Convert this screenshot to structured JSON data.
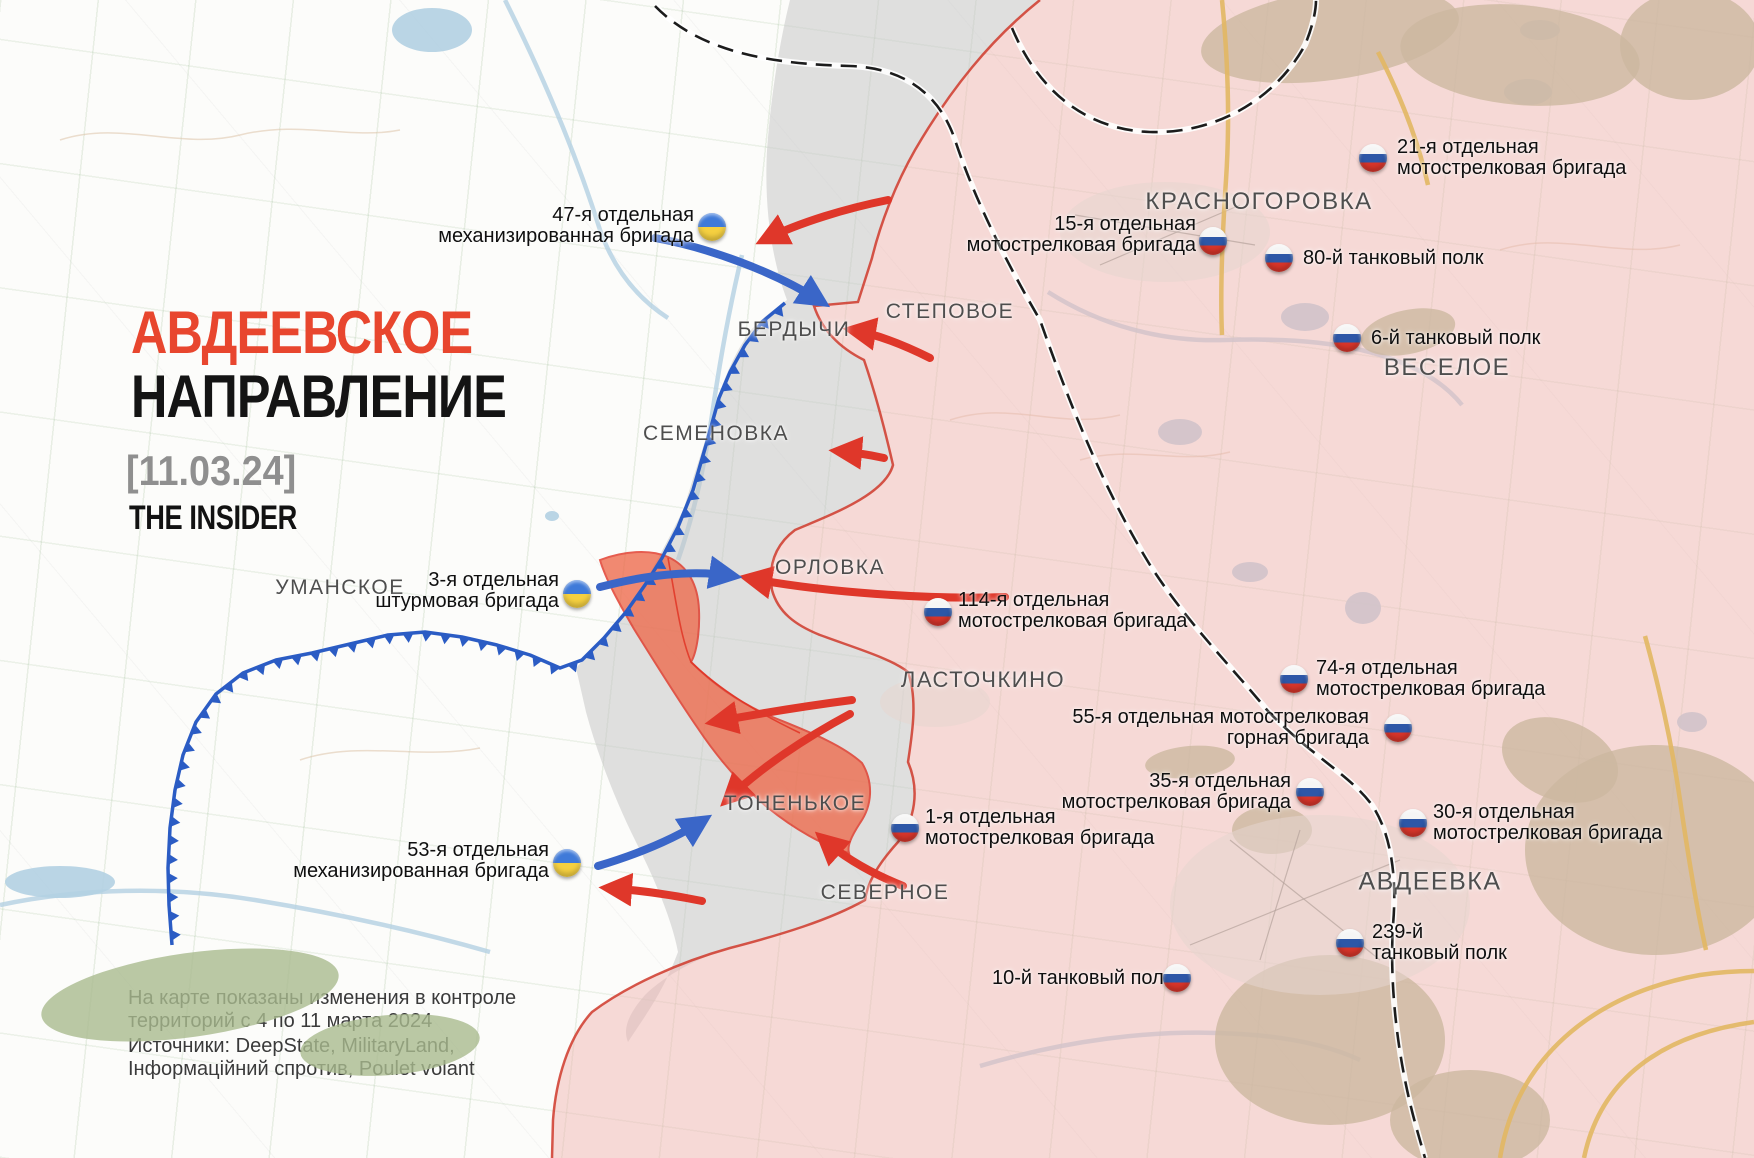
{
  "title": {
    "line1": "АВДЕЕВСКОЕ",
    "line2": "НАПРАВЛЕНИЕ",
    "date": "[11.03.24]",
    "brand": "THE INSIDER",
    "line1_color": "#e8462e",
    "line2_color": "#141414"
  },
  "footer": {
    "note_line1": "На карте показаны изменения в контроле",
    "note_line2": "территорий с 4 по 11 марта 2024",
    "sources_line1": "Источники: DeepState, MilitaryLand,",
    "sources_line2": "Інформаційний спротив, Poulet volant"
  },
  "places": [
    {
      "name": "БЕРДЫЧИ",
      "x": 794,
      "y": 330,
      "size": 21
    },
    {
      "name": "СТЕПОВОЕ",
      "x": 950,
      "y": 312,
      "size": 21
    },
    {
      "name": "СЕМЕНОВКА",
      "x": 716,
      "y": 434,
      "size": 21
    },
    {
      "name": "ОРЛОВКА",
      "x": 830,
      "y": 568,
      "size": 21
    },
    {
      "name": "УМАНСКОЕ",
      "x": 340,
      "y": 588,
      "size": 21
    },
    {
      "name": "ЛАСТОЧКИНО",
      "x": 983,
      "y": 680,
      "size": 22
    },
    {
      "name": "ТОНЕНЬКОЕ",
      "x": 795,
      "y": 804,
      "size": 21
    },
    {
      "name": "СЕВЕРНОЕ",
      "x": 885,
      "y": 893,
      "size": 21
    },
    {
      "name": "КРАСНОГОРОВКА",
      "x": 1259,
      "y": 202,
      "size": 24
    },
    {
      "name": "ВЕСЕЛОЕ",
      "x": 1447,
      "y": 368,
      "size": 24
    },
    {
      "name": "АВДЕЕВКА",
      "x": 1430,
      "y": 882,
      "size": 25
    }
  ],
  "units": [
    {
      "country": "ua",
      "lines": [
        "47-я отдельная",
        "механизированная бригада"
      ]
    },
    {
      "country": "ua",
      "lines": [
        "3-я отдельная",
        "штурмовая бригада"
      ]
    },
    {
      "country": "ua",
      "lines": [
        "53-я отдельная",
        "механизированная бригада"
      ]
    },
    {
      "country": "ru",
      "lines": [
        "21-я отдельная",
        "мотострелковая бригада"
      ]
    },
    {
      "country": "ru",
      "lines": [
        "15-я отдельная",
        "мотострелковая бригада"
      ]
    },
    {
      "country": "ru",
      "lines": [
        "80-й танковый полк"
      ]
    },
    {
      "country": "ru",
      "lines": [
        "6-й танковый полк"
      ]
    },
    {
      "country": "ru",
      "lines": [
        "114-я отдельная",
        "мотострелковая бригада"
      ]
    },
    {
      "country": "ru",
      "lines": [
        "74-я отдельная",
        "мотострелковая бригада"
      ]
    },
    {
      "country": "ru",
      "lines": [
        "55-я отдельная мотострелковая",
        "горная бригада"
      ]
    },
    {
      "country": "ru",
      "lines": [
        "35-я отдельная",
        "мотострелковая бригада"
      ]
    },
    {
      "country": "ru",
      "lines": [
        "30-я отдельная",
        "мотострелковая бригада"
      ]
    },
    {
      "country": "ru",
      "lines": [
        "1-я отдельная",
        "мотострелковая бригада"
      ]
    },
    {
      "country": "ru",
      "lines": [
        "239-й",
        "танковый полк"
      ]
    },
    {
      "country": "ru",
      "lines": [
        "10-й танковый полк"
      ]
    }
  ],
  "colors": {
    "pink_zone": "#efb6b1",
    "pink_edge": "#cf3a2c",
    "gray_zone": "#c7c7c7",
    "orange_zone": "#ee6a4b",
    "orange_edge": "#e03020",
    "frontline": "#2b5cc4",
    "blue_arrow": "#3a66c8",
    "red_arrow": "#df372a",
    "rail": "#1c1c1c",
    "road": "#e2b763",
    "forest": "#a9ba8e",
    "water": "#b3d0e2",
    "contour": "#d9bd9f",
    "urban": "#e6d6d0",
    "urban_street": "#b5a29b"
  },
  "map": {
    "frontline": [
      [
        785,
        303
      ],
      [
        762,
        322
      ],
      [
        745,
        345
      ],
      [
        730,
        372
      ],
      [
        719,
        398
      ],
      [
        706,
        445
      ],
      [
        693,
        490
      ],
      [
        678,
        527
      ],
      [
        662,
        558
      ],
      [
        645,
        585
      ],
      [
        626,
        612
      ],
      [
        604,
        638
      ],
      [
        582,
        660
      ],
      [
        560,
        668
      ],
      [
        530,
        655
      ],
      [
        497,
        645
      ],
      [
        462,
        637
      ],
      [
        425,
        632
      ],
      [
        388,
        635
      ],
      [
        350,
        644
      ],
      [
        312,
        653
      ],
      [
        276,
        660
      ],
      [
        243,
        673
      ],
      [
        216,
        694
      ],
      [
        196,
        722
      ],
      [
        183,
        755
      ],
      [
        175,
        790
      ],
      [
        170,
        828
      ],
      [
        168,
        868
      ],
      [
        169,
        905
      ],
      [
        172,
        945
      ]
    ],
    "zones": {
      "gray": "M 790,0 L 1040,0 C 990,40 950,90 915,150 C 895,185 880,225 872,258 L 858,302 L 814,306 C 822,330 840,348 864,360 C 876,395 885,430 893,465 C 885,495 830,515 795,530 C 775,545 768,565 772,590 C 778,612 795,625 820,635 C 855,648 890,658 908,672 C 918,700 912,735 908,762 C 920,790 915,820 898,842 C 880,862 868,880 865,900 C 830,920 780,935 730,948 C 700,957 665,975 645,995 C 630,1012 622,1028 628,1042 C 642,1020 662,995 678,952 C 672,920 655,880 636,842 C 616,802 598,756 586,712 L 576,668 C 592,650 610,630 627,610 C 647,580 666,545 684,508 C 698,462 709,430 716,405 C 723,380 735,352 751,330 C 765,315 777,308 787,300 C 772,260 764,210 767,150 C 771,95 780,40 790,0 Z",
      "pink": "M 1040,0 C 990,40 950,90 915,150 C 895,185 880,225 872,258 L 858,302 L 814,306 C 822,330 840,348 864,360 C 876,395 885,430 893,465 C 885,495 830,515 795,530 C 775,545 768,565 772,590 C 778,612 795,625 820,635 C 855,648 890,658 908,672 C 918,700 912,735 908,762 C 920,790 915,820 898,842 C 880,862 868,880 865,900 C 830,920 780,935 730,948 C 680,962 628,985 592,1012 C 568,1038 556,1080 553,1120 L 552,1158 L 1754,1158 L 1754,0 Z",
      "pink_edge": "M 1040,0 C 990,40 950,90 915,150 C 895,185 880,225 872,258 L 858,302 L 814,306 C 822,330 840,348 864,360 C 876,395 885,430 893,465 C 885,495 830,515 795,530 C 775,545 768,565 772,590 C 778,612 795,625 820,635 C 855,648 890,658 908,672 C 918,700 912,735 908,762 C 920,790 915,820 898,842 C 880,862 868,880 865,900 C 830,920 780,935 730,948 C 680,962 628,985 592,1012 C 568,1038 556,1080 553,1120 L 552,1158",
      "orange": "M 600,560 C 624,551 650,549 668,557 C 688,566 698,585 699,610 C 700,634 696,654 691,662 C 714,685 740,703 770,716 C 804,730 840,743 862,763 C 874,783 872,806 860,823 C 851,837 847,846 849,853 C 824,846 794,829 767,807 C 741,785 717,757 697,727 C 675,695 654,661 634,629 C 619,603 606,580 600,560 Z",
      "orange_inner": [
        "M 668,558 C 676,600 680,635 691,662",
        "M 691,662 C 720,690 756,712 800,733"
      ]
    },
    "red_arrows": [
      "M 888,200 C 848,208 800,222 764,240",
      "M 930,358 C 902,344 876,334 852,330",
      "M 884,458 C 866,454 850,452 838,451",
      "M 1005,597 C 930,600 820,592 748,578",
      "M 852,700 C 806,706 762,713 714,722",
      "M 850,714 C 805,738 760,768 727,800",
      "M 903,886 C 868,872 842,856 822,838",
      "M 702,901 C 668,894 636,890 608,888"
    ],
    "blue_arrows": [
      "M 655,238 C 710,248 775,272 822,302",
      "M 600,587 C 650,574 695,570 733,576",
      "M 598,866 C 638,854 676,838 704,820"
    ],
    "railways": [
      "M 655,6 C 700,52 770,64 850,66 C 905,68 940,95 955,140 C 975,200 1005,260 1040,320 C 1075,420 1110,500 1150,565 C 1185,620 1230,665 1267,710 C 1310,755 1350,775 1372,805 C 1392,835 1397,880 1393,925 C 1390,975 1395,1030 1405,1080 C 1412,1115 1420,1140 1425,1158",
      "M 1012,28 C 1040,95 1090,130 1150,132 C 1215,134 1275,100 1305,45 C 1312,28 1316,12 1316,0"
    ],
    "roads": [
      "M 1222,0 C 1228,60 1230,120 1226,180 C 1222,240 1220,290 1222,335",
      "M 1645,636 C 1660,690 1672,745 1680,800 C 1688,855 1696,905 1706,950",
      "M 1500,1158 C 1516,1060 1590,995 1700,975 C 1720,972 1740,971 1754,971",
      "M 1584,1158 C 1600,1080 1660,1035 1754,1022",
      "M 1378,52 C 1400,95 1418,140 1428,185"
    ],
    "forests": [
      [
        1330,
        35,
        130,
        45,
        -8
      ],
      [
        1520,
        55,
        120,
        50,
        5
      ],
      [
        1690,
        45,
        70,
        55,
        0
      ],
      [
        1408,
        332,
        48,
        22,
        -12
      ],
      [
        1655,
        850,
        130,
        105,
        0
      ],
      [
        1560,
        760,
        60,
        40,
        20
      ],
      [
        1330,
        1040,
        115,
        85,
        0
      ],
      [
        1470,
        1120,
        80,
        50,
        0
      ],
      [
        190,
        995,
        150,
        42,
        -8
      ],
      [
        390,
        1045,
        90,
        30,
        -5
      ],
      [
        1272,
        830,
        40,
        24,
        0
      ],
      [
        1190,
        762,
        45,
        16,
        -5
      ]
    ],
    "lakes": [
      [
        432,
        30,
        40,
        22
      ],
      [
        1305,
        317,
        24,
        14
      ],
      [
        1528,
        92,
        24,
        13
      ],
      [
        1180,
        432,
        22,
        13
      ],
      [
        1363,
        608,
        18,
        16
      ],
      [
        1250,
        572,
        18,
        10
      ],
      [
        1692,
        722,
        15,
        10
      ],
      [
        552,
        516,
        7,
        5
      ],
      [
        60,
        882,
        55,
        16
      ],
      [
        1540,
        30,
        20,
        10
      ]
    ],
    "streams": [
      "M 505,0 C 540,70 575,150 600,230 C 615,272 640,300 668,318",
      "M 1048,292 C 1100,325 1160,342 1225,340 C 1290,338 1350,342 1400,362 C 1430,374 1450,390 1462,405",
      "M 980,1066 C 1060,1042 1150,1028 1240,1034 C 1290,1037 1330,1046 1360,1060",
      "M 0,905 C 80,888 170,886 255,900 C 340,914 420,932 490,952",
      "M 742,255 C 730,305 720,360 712,415 C 704,470 692,520 678,560"
    ],
    "contours": [
      "M 60,140 C 120,120 180,150 240,135 C 300,120 350,140 400,130",
      "M 950,420 C 1010,400 1060,430 1120,415",
      "M 1500,250 C 1560,230 1620,260 1680,245",
      "M 300,760 C 360,740 420,760 480,748",
      "M 1080,460 C 1130,445 1180,465 1230,452"
    ],
    "urban": [
      [
        1165,
        232,
        105,
        50
      ],
      [
        1320,
        905,
        150,
        90
      ],
      [
        935,
        702,
        55,
        25
      ]
    ],
    "urban_streets": [
      "M 1075,215 L 1255,245",
      "M 1100,265 L 1240,205",
      "M 1190,945 L 1400,860",
      "M 1230,840 L 1380,960",
      "M 1260,960 L 1300,830"
    ]
  }
}
